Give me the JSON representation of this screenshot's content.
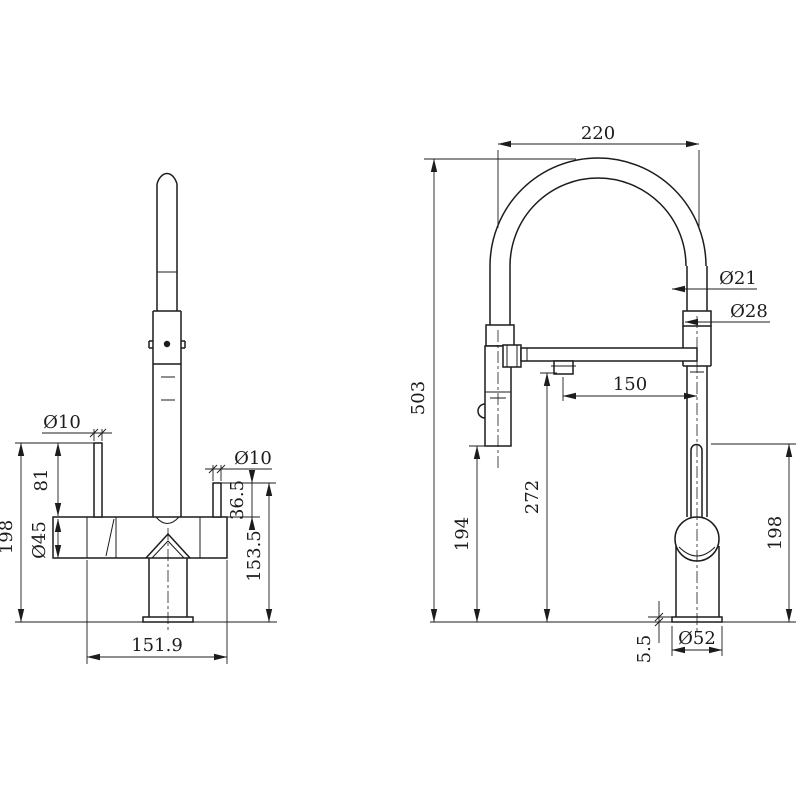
{
  "drawing": {
    "type": "faucet-technical-drawing",
    "background": "#ffffff",
    "line_color": "#1c1c1c",
    "views": {
      "side": {
        "name": "side view",
        "dims": {
          "handle_dia": "Ø10",
          "handle_height": "81",
          "overall_height": "198",
          "body_dia": "Ø45",
          "filter_handle_dia": "Ø10",
          "filter_handle_height": "36.5",
          "filter_handle_top": "153.5",
          "body_length": "151.9"
        }
      },
      "front": {
        "name": "front view",
        "dims": {
          "spout_width": "220",
          "hose_dia": "Ø21",
          "collar_dia": "Ø28",
          "spout_reach": "150",
          "overall_height": "503",
          "spray_clearance": "194",
          "outlet_height": "272",
          "body_height": "198",
          "base_plate": "5.5",
          "base_dia": "Ø52"
        }
      }
    }
  }
}
